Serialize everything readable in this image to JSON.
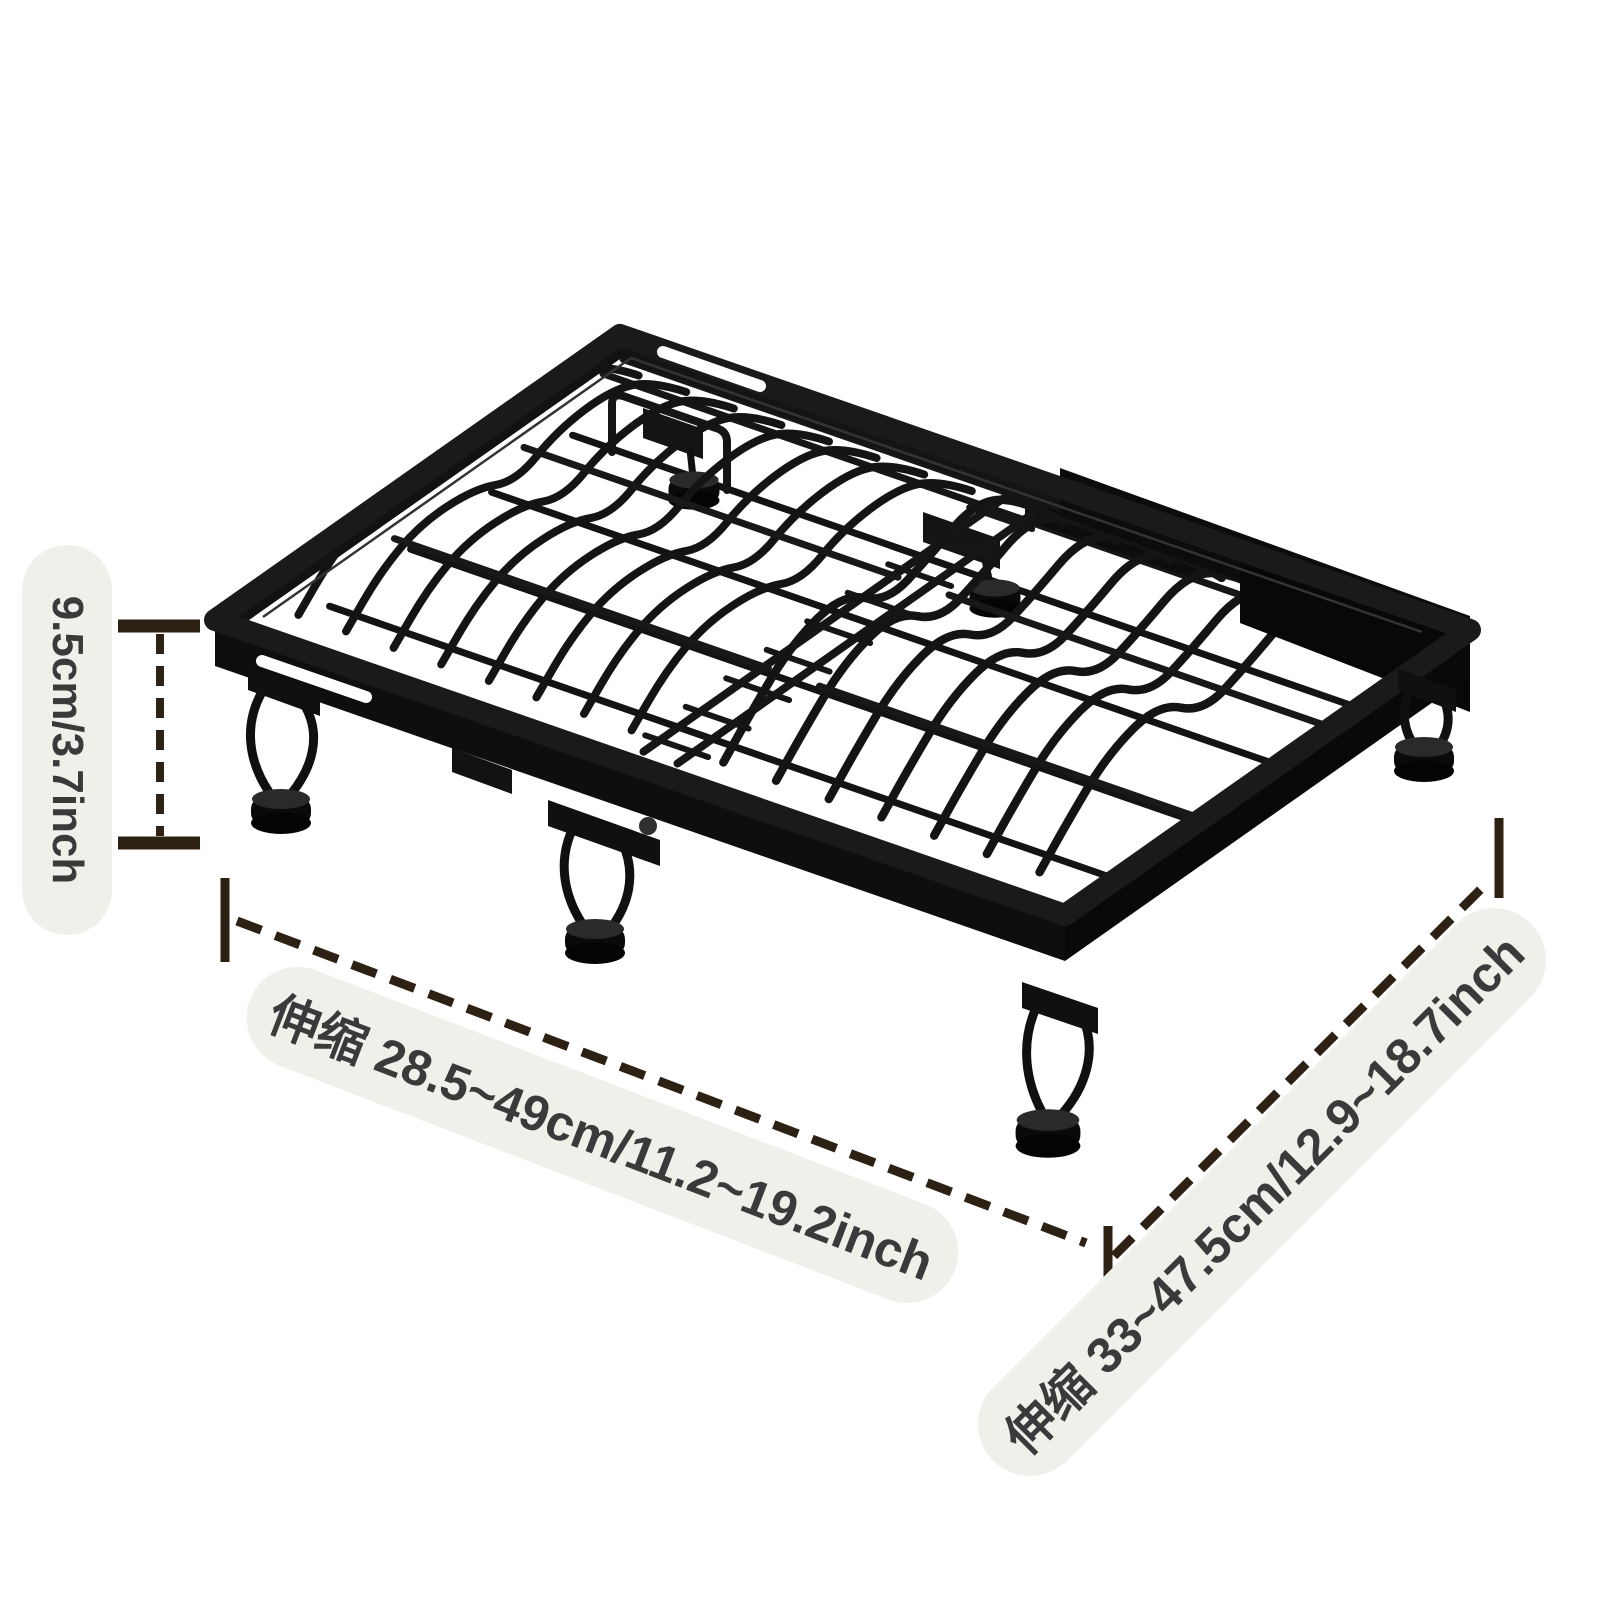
{
  "labels": {
    "height": "9.5cm/3.7inch",
    "width": "伸缩 28.5~49cm/11.2~19.2inch",
    "depth": "伸缩 33~47.5cm/12.9~18.7inch"
  },
  "styles": {
    "background": "#ffffff",
    "pill_bg": "#edf1ea",
    "label_text": "#3a3a3a",
    "dimension_line": "#2d2113",
    "rack_black": "#111111",
    "rack_wire": "#141414"
  }
}
